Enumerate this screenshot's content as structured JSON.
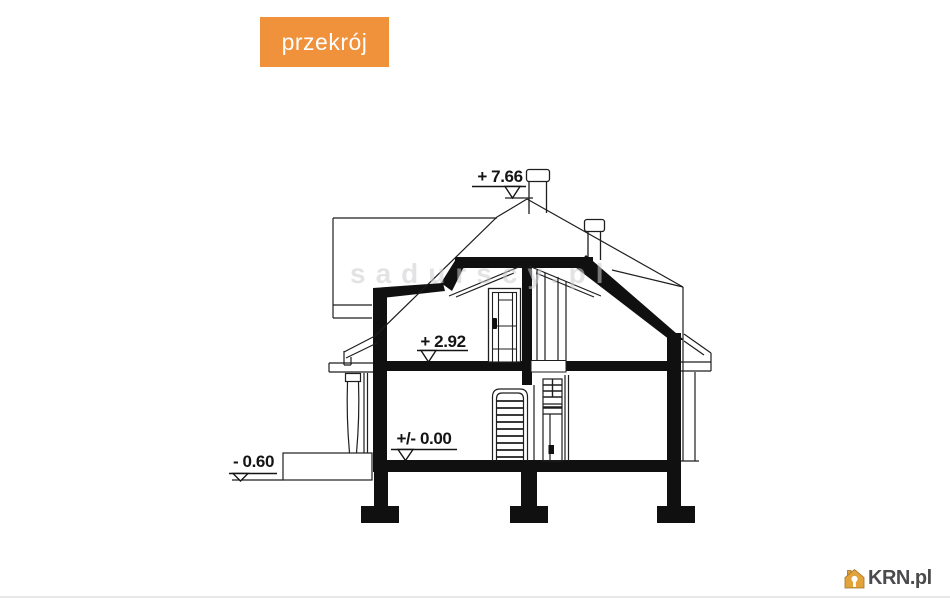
{
  "badge": {
    "label": "przekrój",
    "background": "#F0923C",
    "text_color": "#ffffff"
  },
  "watermark": {
    "text": "sadurscy.pl",
    "color": "#cdcdd2"
  },
  "drawing": {
    "type": "architectural-cross-section",
    "line_color": "#1e1e1e",
    "levels": [
      {
        "id": "ridge",
        "label": "+ 7.66"
      },
      {
        "id": "attic-floor",
        "label": "+ 2.92"
      },
      {
        "id": "ground-floor",
        "label": "+/- 0.00"
      },
      {
        "id": "terrace",
        "label": "- 0.60"
      }
    ],
    "features": [
      "hip-roof",
      "chimney",
      "vent-stack",
      "attic-door",
      "staircase",
      "interior-door",
      "porch-column",
      "terrace-slab",
      "foundation-footings"
    ]
  },
  "footer": {
    "logo_text": "KRN.pl",
    "logo_text_color": "#4b4b4d",
    "house_icon_color": "#E2A33B",
    "divider_color": "#e7e7e9"
  }
}
